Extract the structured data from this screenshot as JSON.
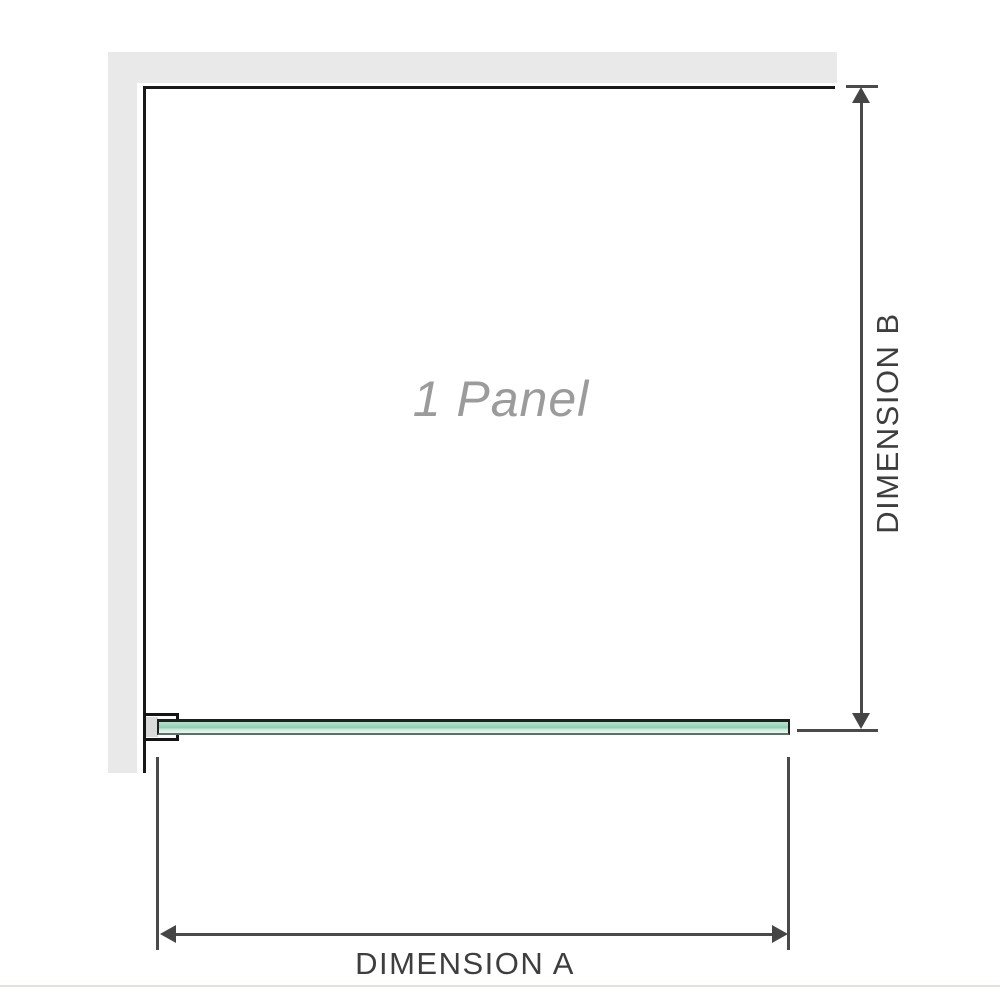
{
  "diagram": {
    "title": "1 Panel shower screen dimension diagram",
    "panel_label": "1 Panel",
    "dimension_a_label": "DIMENSION A",
    "dimension_b_label": "DIMENSION B",
    "colors": {
      "wall_gray": "#e9e9e9",
      "panel_outline": "#191919",
      "dimension_line": "#4a4a4a",
      "arrowhead": "#454545",
      "dimension_label_text": "#3e3e3e",
      "panel_label_text": "#9b9b9b",
      "glass_green_top": "#a3d8bd",
      "glass_green_bottom": "#eaf7f0",
      "bracket_liner": "#dadada"
    }
  }
}
